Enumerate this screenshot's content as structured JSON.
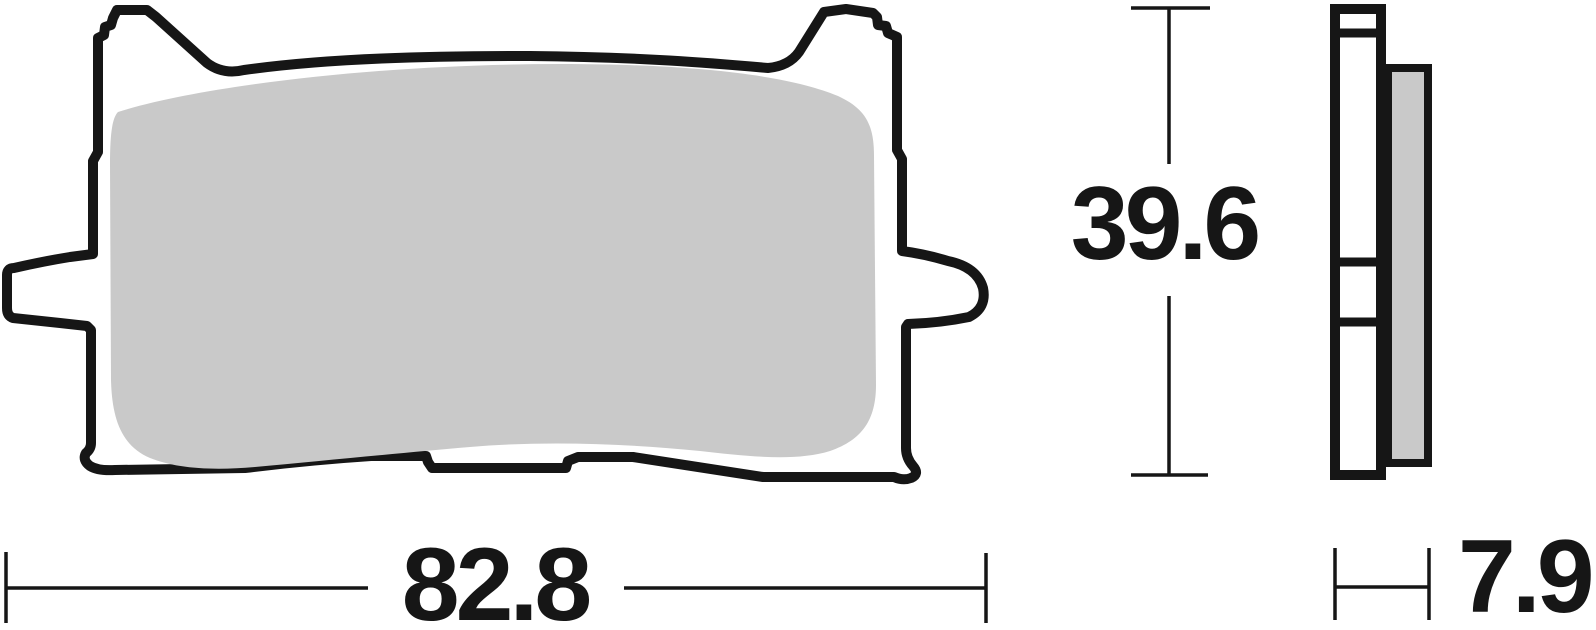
{
  "dimensions": {
    "height": "39.6",
    "width": "82.8",
    "thickness": "7.9"
  },
  "views": {
    "front": "brake-pad-front-view",
    "side": "brake-pad-side-view"
  },
  "colors": {
    "outline": "#161616",
    "friction_material": "#c9c9c9",
    "plate_fill": "#ffffff",
    "background": "#ffffff"
  }
}
